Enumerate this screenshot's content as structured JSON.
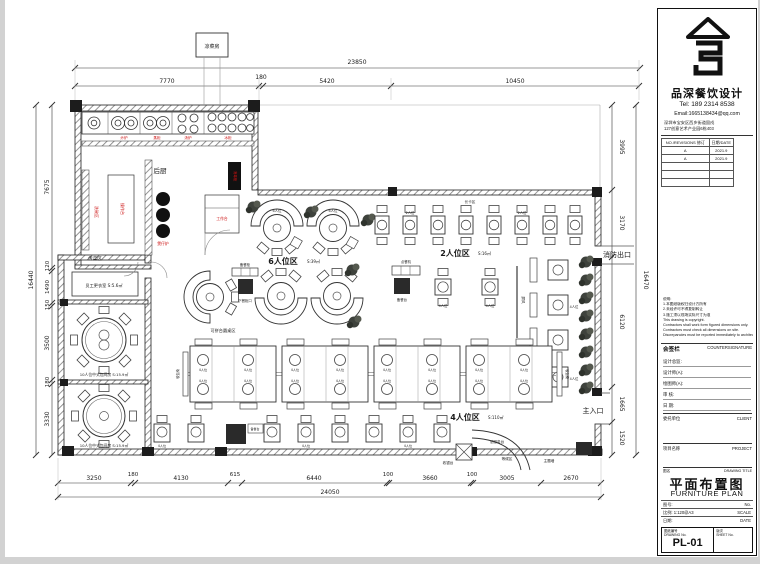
{
  "plan": {
    "dims": {
      "top_total": "23850",
      "top": [
        "7770",
        "180",
        "5420",
        "10450"
      ],
      "left_total": "16440",
      "left": [
        "7675",
        "120",
        "1490",
        "150",
        "3500",
        "180",
        "3330"
      ],
      "right_total": "16470",
      "right": [
        "3995",
        "3170",
        "6120",
        "1665",
        "1520"
      ],
      "bottom_total": "24050",
      "bottom": [
        "3250",
        "180",
        "4130",
        "615",
        "6440",
        "100",
        "3660",
        "100",
        "3005",
        "2670"
      ]
    },
    "zones": {
      "kitchen": "后厨",
      "zone6": "6人位区",
      "zone6_area": "S:39㎡",
      "zone2": "2人位区",
      "zone2_area": "S:16㎡",
      "zone4": "4人位区",
      "zone4_area": "S:110㎡",
      "round_zone": "可拼台圆桌区",
      "banquette": "长卡区",
      "fire_exit": "消防出口",
      "entrance": "主入口",
      "staff_room": "员工更衣室 S:5.6㎡",
      "room1": "10人位中式包间房 S:15.9㎡",
      "room2": "10人位中式包间房 S:15.9㎡",
      "pass": "传菜区",
      "annex": "凉菜房"
    },
    "furniture": {
      "seat2": "2人位",
      "seat4": "4人位",
      "seat6": "6人位",
      "bench": "软包椅",
      "screen": "屏风",
      "reception": "总服务台",
      "cashier": "收银台",
      "waiting": "等候区",
      "theme_wall": "主题墙",
      "order_machine": "点餐机",
      "prep_table": "备餐台",
      "serve_cab": "备餐柜",
      "lower_cab": "下餐柜口"
    },
    "kitchen_labels": {
      "stove": "炒炉",
      "steam": "蒸柜",
      "soup": "汤炉",
      "fridge": "冰柜",
      "pot": "煲仔炉",
      "wash": "洗碗区",
      "prep": "操作台",
      "work": "工作台",
      "disinfect": "消毒柜"
    }
  },
  "title_block": {
    "company": "品深餐饮设计",
    "tel": "Tel: 189 2314 8538",
    "email": "Email:1665138434@qq.com",
    "address1": "深圳市宝安区西乡街道固戍",
    "address2": "127创意艺术产业园6栋403",
    "revisions": {
      "col1": "NO./REVISIONS 修订",
      "col2": "日期/DATE",
      "rows": [
        [
          "A",
          "2021.9"
        ],
        [
          "A",
          "2021.9"
        ],
        [
          "",
          ""
        ],
        [
          "",
          ""
        ],
        [
          "",
          ""
        ]
      ]
    },
    "notes": [
      "说明:",
      "1.本图纸版权归设计方所有",
      "2.未经许可不得复制转让",
      "3.施工须以现场实际尺寸为准",
      "This drawing is copyright.",
      "Contractors shall work form figured dimensions only.",
      "Contractors must check all dimensions on site.",
      "Discrepancies must be reported immediately to architects."
    ],
    "countersign_zh": "会签栏",
    "countersign_en": "COUNTERSIGNATURE",
    "sign_rows": [
      "设计总监:",
      "设计师(A):",
      "绘图师(A):",
      "审  核:",
      "日  期:"
    ],
    "client_zh": "委托单位",
    "client_en": "CLIENT",
    "project_zh": "项目名称",
    "project_en": "PROJECT",
    "title_row_zh": "图名",
    "title_row_en": "DRAWING TITLE",
    "sheet_title_zh": "平面布置图",
    "sheet_title_en": "FURNITURE PLAN",
    "meta_rows": [
      {
        "left": "图号:",
        "right": "No."
      },
      {
        "left": "比例: 1:120@A3",
        "right": "SCALE"
      },
      {
        "left": "日期:",
        "right": "DATE"
      }
    ],
    "drawing_no_zh": "图纸编号",
    "drawing_no_en": "DRAWING No.",
    "sheet_no": "PL-01",
    "sheet_no_zh": "版次",
    "sheet_no_en": "SHEET No."
  }
}
